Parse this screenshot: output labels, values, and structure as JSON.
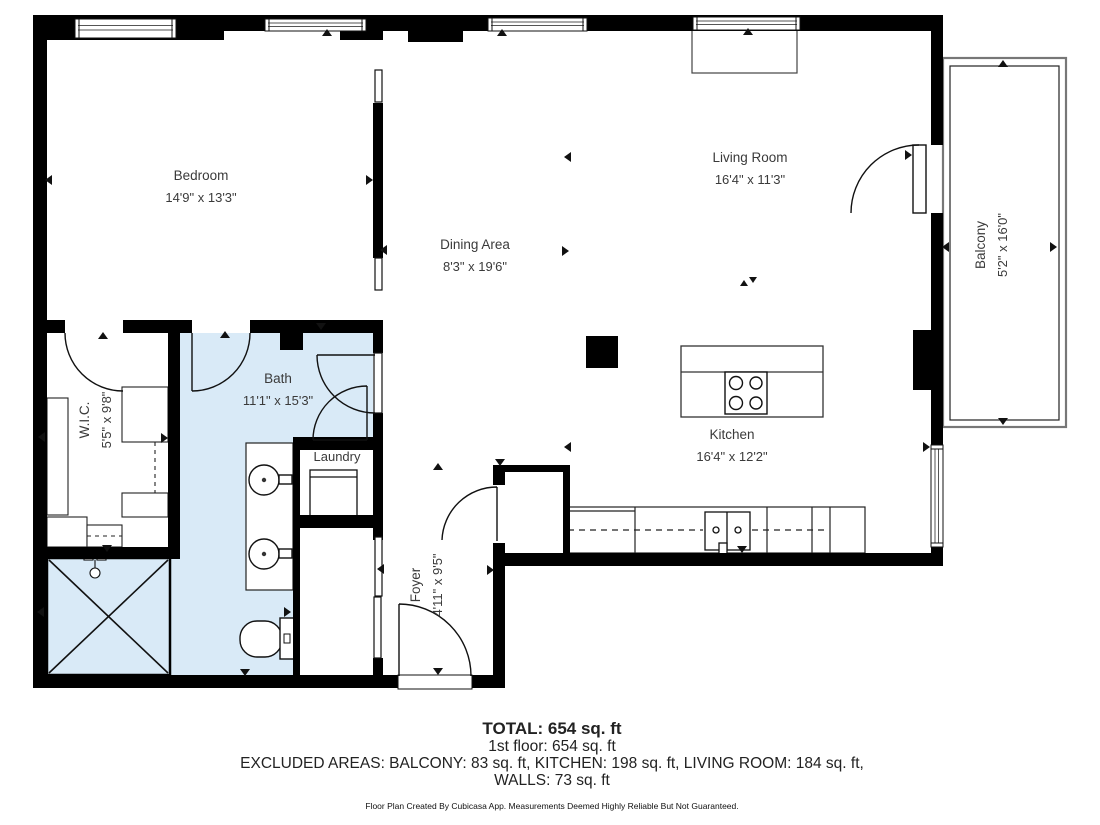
{
  "rooms": {
    "bedroom": {
      "name": "Bedroom",
      "dims": "14'9\" x 13'3\""
    },
    "dining": {
      "name": "Dining Area",
      "dims": "8'3\" x 19'6\""
    },
    "living": {
      "name": "Living Room",
      "dims": "16'4\" x 11'3\""
    },
    "balcony": {
      "name": "Balcony",
      "dims": "5'2\" x 16'0\""
    },
    "wic": {
      "name": "W.I.C.",
      "dims": "5'5\" x 9'8\""
    },
    "bath": {
      "name": "Bath",
      "dims": "11'1\" x 15'3\""
    },
    "laundry": {
      "name": "Laundry"
    },
    "foyer": {
      "name": "Foyer",
      "dims": "4'11\" x 9'5\""
    },
    "kitchen": {
      "name": "Kitchen",
      "dims": "16'4\" x 12'2\""
    }
  },
  "summary": {
    "total": "TOTAL: 654 sq. ft",
    "floor": "1st floor: 654 sq. ft",
    "excluded": "EXCLUDED AREAS: BALCONY: 83 sq. ft, KITCHEN: 198 sq. ft, LIVING ROOM: 184 sq. ft,",
    "walls": "WALLS: 73 sq. ft",
    "disclaimer": "Floor Plan Created By Cubicasa App. Measurements Deemed Highly Reliable But Not Guaranteed."
  },
  "colors": {
    "wall": "#000000",
    "bath_fill": "#d9eaf7",
    "background": "#ffffff",
    "line": "#111111"
  }
}
